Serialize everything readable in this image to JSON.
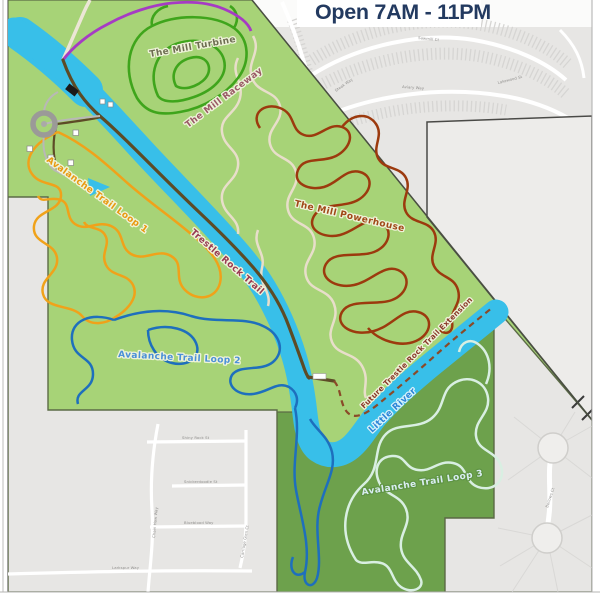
{
  "title": {
    "text": "Open 7AM - 11PM",
    "color": "#233a60"
  },
  "colors": {
    "urban": "#e7e6e4",
    "urban_top_band": "#fbfbfa",
    "parcel": "#edecea",
    "park_light": "#a7d377",
    "park_dark": "#6da14c",
    "park_border": "#5c6b46",
    "parcel_border": "#4a4a47",
    "river": "#38bfe9",
    "road_white": "#ffffff",
    "access_road": "#ece6d6",
    "purple_trail": "#a63bc4"
  },
  "trails": {
    "mill_turbine": {
      "name": "The Mill Turbine",
      "color": "#3fa51c",
      "label_color": "#6e6e52"
    },
    "mill_raceway": {
      "name": "The Mill Raceway",
      "color": "#e8deca",
      "label_color": "#9a5a66"
    },
    "mill_powerhouse": {
      "name": "The Mill Powerhouse",
      "color": "#9c3a0e",
      "label_color": "#a04818"
    },
    "trestle_rock": {
      "name": "Trestle Rock Trail",
      "color": "#5d4b26",
      "label_color": "#993a52"
    },
    "future_extension": {
      "name": "Future Trestle Rock Trail Extension",
      "color": "#8a4a28",
      "label_color": "#8a3a2a"
    },
    "avalanche_1": {
      "name": "Avalanche Trail Loop 1",
      "color": "#f0a21a",
      "label_color": "#e8990f"
    },
    "avalanche_2": {
      "name": "Avalanche Trail Loop 2",
      "color": "#1e6fbd",
      "label_color": "#4a90d8"
    },
    "avalanche_3": {
      "name": "Avalanche Trail Loop 3",
      "color": "#d9efe2",
      "label_color": "#daedf2"
    }
  },
  "river_label": {
    "name": "Little River",
    "color": "#2e86d8"
  },
  "streets": {
    "shiny_rock": "Shiny Rock St",
    "snickerdoodle": "Snickerdoodle St",
    "blueblood": "Blueblood Way",
    "larkspur": "Larkspur Way",
    "chain_haw": "Chain Haw Way",
    "carriage_glen": "Carriage Glen Ct",
    "bellows": "Bellows Ct",
    "sawmill": "Sawmill Ct",
    "aviary": "Aviary Way",
    "lakewood": "Lakewood St",
    "steak": "Steak Way"
  }
}
